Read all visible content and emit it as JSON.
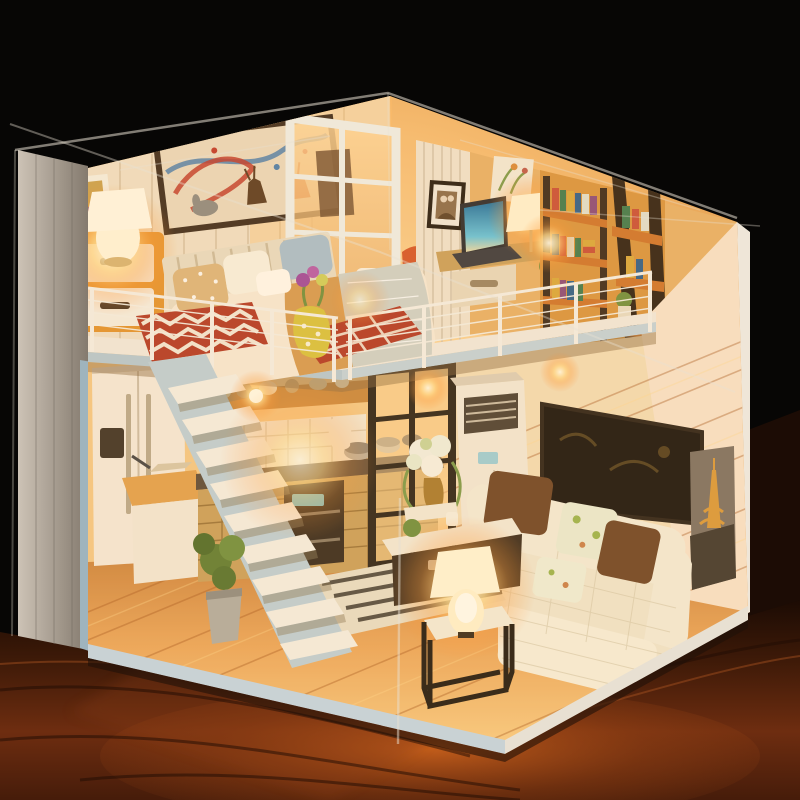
{
  "scene": {
    "type": "photograph",
    "caption": "Warm-lit DIY miniature loft dollhouse diorama under a clear acrylic cover, standing on a dark reddish wooden table against a black background",
    "lighting": "warm interior LED glow, dark surroundings",
    "display": {
      "cover": "clear acrylic box",
      "surface": "dark polished wood table",
      "background": "black"
    }
  },
  "palette": {
    "background": "#070605",
    "table_dark": "#1a0b04",
    "table_warm": "#7a3412",
    "wall_left": "#b9aea2",
    "wall_right": "#ecd2ba",
    "trim_white": "#f1eade",
    "fascia_blue": "#b6c9d2",
    "floor_wood": "#e2a156",
    "glow_warm": "#ffbe66",
    "bed_white": "#f6ead7",
    "blanket_tan": "#d59a51",
    "blanket_silver": "#cfd2c9",
    "pillow_blue": "#a8bfcd",
    "pillow_tan": "#dcb67d",
    "rug_red": "#b23a26",
    "nightstand_wood": "#e2932f",
    "drawer_white": "#f4eee2",
    "handle_dark": "#3a2d22",
    "stairs_white": "#f4efe4",
    "stairs_stringer": "#bdd0d8",
    "counter_basket": "#c9a05c",
    "oven_dark": "#352a1e",
    "partition_black": "#2c241a",
    "sofa_cream": "#f3ecd9",
    "cushion_brown": "#6e4526",
    "cushion_floral": "#eaecd4",
    "art_dark": "#17130e",
    "eiffel_sky": "#7c7064",
    "eiffel_gold": "#d9993b",
    "ac_white": "#f2e9d8",
    "laptop_screen": "#2a84b0",
    "plant_green": "#5f7d33",
    "chair_orange": "#d4562a",
    "shelf_orange": "#cf752c",
    "lamp_core": "#fff6d8"
  },
  "objects": {
    "display": [
      "acrylic-cover-edges",
      "wood-table-reflection"
    ],
    "loft_floor": [
      "deer-ribbon-wall-art",
      "nightstand",
      "bedside-lamp",
      "photo-card",
      "double-bed",
      "polka-pillow",
      "white-pillow",
      "blue-pillow",
      "tan-blanket",
      "silver-throw",
      "chevron-rug",
      "check-rug",
      "flower-vase",
      "white-grid-partition-door",
      "bathroom-toilet",
      "orange-chair",
      "striped-study-wall",
      "couple-photo-frame",
      "floral-art",
      "laptop",
      "desk-lamp",
      "writing-desk",
      "bookshelf-wall",
      "ladder-bookshelf",
      "books",
      "shelf-plant",
      "wire-railing"
    ],
    "ground_floor": [
      "white-staircase",
      "refrigerator",
      "kitchen-island",
      "basket-front-cabinets",
      "tile-backsplash",
      "wall-oven",
      "cookware",
      "black-grid-partition",
      "floor-standing-ac",
      "hydrangea-arrangement",
      "dark-wall-artwork",
      "eiffel-tower-photo",
      "l-shaped-knit-sofa",
      "brown-cushions",
      "floral-cushions",
      "ottoman",
      "console-table",
      "striped-rug",
      "cube-side-table",
      "glowing-table-lamp",
      "potted-plant",
      "plank-floor"
    ]
  }
}
